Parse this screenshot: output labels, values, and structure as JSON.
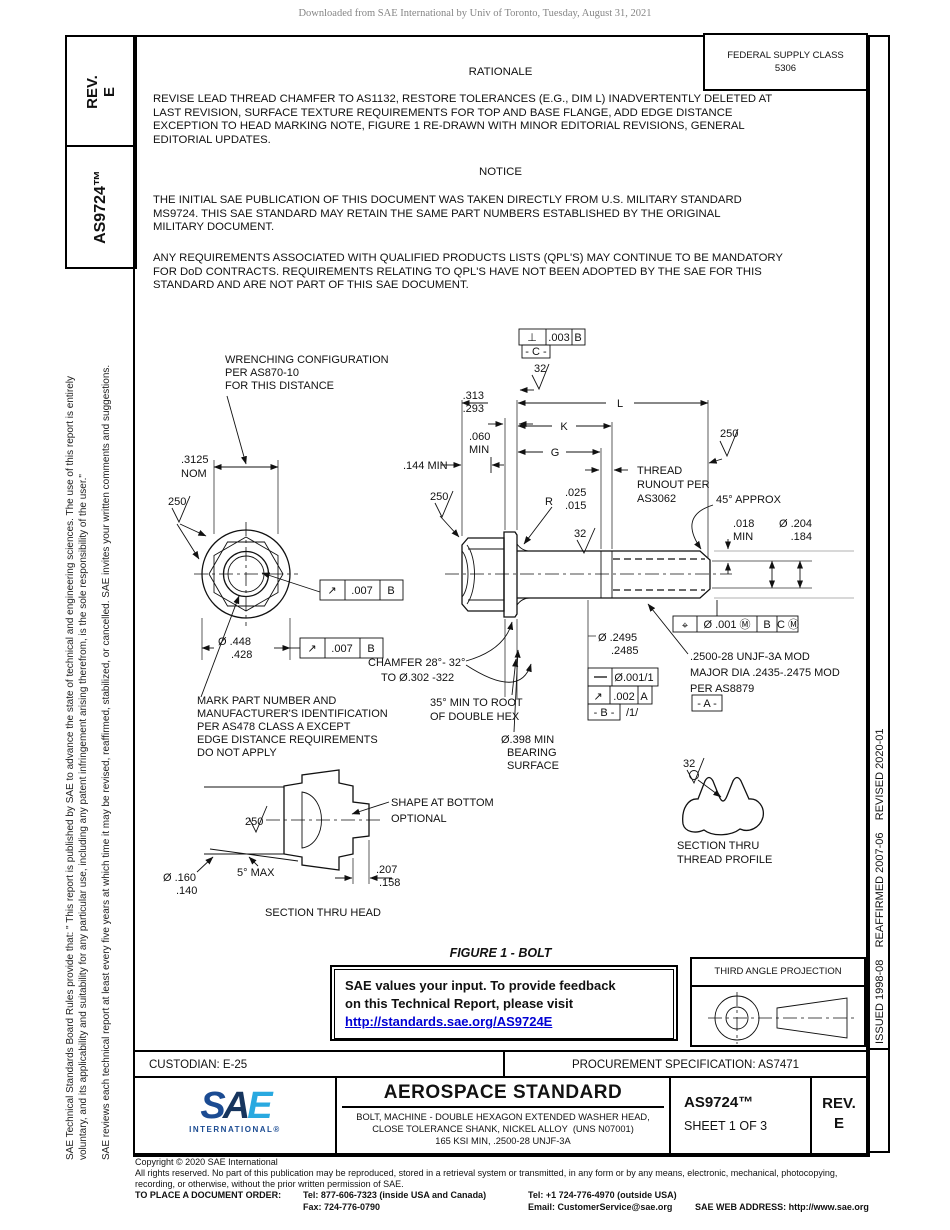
{
  "watermark": "Downloaded from SAE International by Univ of Toronto, Tuesday, August 31, 2021",
  "left_tabs": {
    "rev": "REV.\nE",
    "doc_number": "AS9724™"
  },
  "sidebar": {
    "para1_lines": [
      "SAE Technical Standards Board Rules provide that: \" This report is published by SAE to advance the state of technical and engineering sciences. The use of this report is entirely",
      "voluntary, and its applicability and suitability for any particular use, including any patent infringement arising therefrom, is the sole responsibility of the user.\""
    ],
    "para2": "SAE reviews each technical report at least every five years at which time it may be revised, reaffirmed, stabilized, or cancelled. SAE invites your written comments and suggestions."
  },
  "right_strip": {
    "text": "ISSUED 1998-08    REAFFIRMED 2007-06    REVISED 2020-01"
  },
  "fsc": {
    "line1": "FEDERAL SUPPLY CLASS",
    "line2": "5306"
  },
  "rationale": {
    "title": "RATIONALE",
    "body_lines": [
      "REVISE LEAD THREAD CHAMFER TO AS1132, RESTORE TOLERANCES (E.G., DIM L) INADVERTENTLY DELETED AT",
      "LAST REVISION, SURFACE TEXTURE REQUIREMENTS FOR TOP AND BASE FLANGE, ADD EDGE DISTANCE",
      "EXCEPTION TO HEAD MARKING NOTE, FIGURE 1 RE-DRAWN WITH MINOR EDITORIAL REVISIONS, GENERAL",
      "EDITORIAL UPDATES."
    ]
  },
  "notice": {
    "title": "NOTICE",
    "para1_lines": [
      "THE INITIAL SAE PUBLICATION OF THIS DOCUMENT WAS TAKEN DIRECTLY FROM U.S. MILITARY STANDARD",
      "MS9724. THIS SAE STANDARD MAY RETAIN THE SAME PART NUMBERS ESTABLISHED BY THE ORIGINAL",
      "MILITARY DOCUMENT."
    ],
    "para2_lines": [
      "ANY REQUIREMENTS ASSOCIATED WITH QUALIFIED PRODUCTS LISTS (QPL'S) MAY CONTINUE TO BE MANDATORY",
      "FOR DoD CONTRACTS. REQUIREMENTS RELATING TO QPL'S HAVE NOT BEEN ADOPTED BY THE SAE FOR THIS",
      "STANDARD AND ARE NOT PART OF THIS SAE DOCUMENT."
    ]
  },
  "figure": {
    "caption": "FIGURE 1 - BOLT",
    "labels": [
      {
        "n": "wrenching-note",
        "x": 225,
        "y": 363,
        "lines": [
          "WRENCHING CONFIGURATION",
          "PER AS870-10",
          "FOR THIS DISTANCE"
        ]
      },
      {
        "n": "fcf-perp-sym",
        "x": 532,
        "y": 341,
        "anchor": "middle",
        "lines": [
          "⊥"
        ]
      },
      {
        "n": "fcf-perp-val",
        "x": 559,
        "y": 341,
        "anchor": "middle",
        "lines": [
          ".003"
        ]
      },
      {
        "n": "fcf-perp-datum",
        "x": 578,
        "y": 341,
        "anchor": "middle",
        "lines": [
          "B"
        ]
      },
      {
        "n": "datum-c",
        "x": 536,
        "y": 355,
        "anchor": "middle",
        "lines": [
          "- C -"
        ]
      },
      {
        "n": "finish-32-top",
        "x": 534,
        "y": 372,
        "lines": [
          "32"
        ]
      },
      {
        "n": "dim-313-293",
        "x": 484,
        "y": 399,
        "anchor": "end",
        "lines": [
          ".313",
          ".293"
        ]
      },
      {
        "n": "dim-L",
        "x": 620,
        "y": 407,
        "anchor": "middle",
        "lines": [
          "L"
        ]
      },
      {
        "n": "dim-K",
        "x": 564,
        "y": 430,
        "anchor": "middle",
        "lines": [
          "K"
        ]
      },
      {
        "n": "dim-G",
        "x": 555,
        "y": 456,
        "anchor": "middle",
        "lines": [
          "G"
        ]
      },
      {
        "n": "dim-060-min",
        "x": 469,
        "y": 440,
        "lines": [
          ".060",
          "MIN"
        ]
      },
      {
        "n": "dim-144-min",
        "x": 403,
        "y": 469,
        "lines": [
          ".144 MIN"
        ]
      },
      {
        "n": "finish-250-shank-end",
        "x": 720,
        "y": 437,
        "lines": [
          "250"
        ]
      },
      {
        "n": "thread-runout-note",
        "x": 637,
        "y": 474,
        "lh": 14,
        "lines": [
          "THREAD",
          "RUNOUT PER",
          "AS3062"
        ]
      },
      {
        "n": "angle-45-approx",
        "x": 716,
        "y": 503,
        "lines": [
          "45° APPROX"
        ]
      },
      {
        "n": "finish-250-head-side",
        "x": 430,
        "y": 500,
        "lines": [
          "250"
        ]
      },
      {
        "n": "radius-r",
        "x": 553,
        "y": 505,
        "anchor": "end",
        "lines": [
          "R"
        ]
      },
      {
        "n": "dim-r-values",
        "x": 565,
        "y": 496,
        "lines": [
          ".025",
          ".015"
        ]
      },
      {
        "n": "dim-018-min",
        "x": 733,
        "y": 527,
        "lines": [
          ".018",
          "MIN"
        ]
      },
      {
        "n": "dim-204-184",
        "x": 812,
        "y": 527,
        "anchor": "end",
        "lines": [
          "Ø .204",
          ".184"
        ]
      },
      {
        "n": "finish-32-shank",
        "x": 574,
        "y": 537,
        "lines": [
          "32"
        ]
      },
      {
        "n": "dim-3125-nom",
        "x": 181,
        "y": 463,
        "lh": 14,
        "lines": [
          ".3125",
          "NOM"
        ]
      },
      {
        "n": "finish-250-head-top",
        "x": 168,
        "y": 505,
        "lines": [
          "250"
        ]
      },
      {
        "n": "dim-2495-2485",
        "x": 598,
        "y": 641,
        "indent": 13,
        "lines": [
          "Ø .2495",
          ".2485"
        ]
      },
      {
        "n": "pos-sym",
        "x": 685,
        "y": 629,
        "anchor": "middle",
        "lines": [
          "⌖"
        ]
      },
      {
        "n": "pos-val",
        "x": 727,
        "y": 628,
        "anchor": "middle",
        "lines": [
          "Ø .001 Ⓜ"
        ]
      },
      {
        "n": "pos-datum-b",
        "x": 767,
        "y": 628,
        "anchor": "middle",
        "lines": [
          "B"
        ]
      },
      {
        "n": "pos-datum-c",
        "x": 788,
        "y": 628,
        "anchor": "middle",
        "lines": [
          "C Ⓜ"
        ]
      },
      {
        "n": "thread-spec-note",
        "x": 690,
        "y": 660,
        "lh": 16,
        "lines": [
          ".2500-28 UNJF-3A MOD",
          "MAJOR DIA .2435-.2475 MOD",
          "PER AS8879"
        ]
      },
      {
        "n": "datum-a",
        "x": 707,
        "y": 707,
        "anchor": "middle",
        "lines": [
          "- A -"
        ]
      },
      {
        "n": "straight-val",
        "x": 634,
        "y": 681,
        "anchor": "middle",
        "lines": [
          "Ø.001/1"
        ]
      },
      {
        "n": "runout-shank-sym",
        "x": 598,
        "y": 700,
        "anchor": "middle",
        "lines": [
          "↗"
        ]
      },
      {
        "n": "runout-shank-val",
        "x": 624,
        "y": 700,
        "anchor": "middle",
        "lines": [
          ".002"
        ]
      },
      {
        "n": "runout-shank-datum",
        "x": 644,
        "y": 700,
        "anchor": "middle",
        "lines": [
          "A"
        ]
      },
      {
        "n": "datum-b",
        "x": 604,
        "y": 716,
        "anchor": "middle",
        "lines": [
          "- B -"
        ]
      },
      {
        "n": "flag-1",
        "x": 626,
        "y": 716,
        "lines": [
          "/1/"
        ]
      },
      {
        "n": "dim-448-428",
        "x": 218,
        "y": 645,
        "indent": 13,
        "lines": [
          "Ø .448",
          ".428"
        ]
      },
      {
        "n": "runout-lower-sym",
        "x": 312,
        "y": 652,
        "anchor": "middle",
        "lines": [
          "↗"
        ]
      },
      {
        "n": "runout-lower-val",
        "x": 342,
        "y": 652,
        "anchor": "middle",
        "lines": [
          ".007"
        ]
      },
      {
        "n": "runout-lower-datum",
        "x": 371,
        "y": 652,
        "anchor": "middle",
        "lines": [
          "B"
        ]
      },
      {
        "n": "runout-upper-sym",
        "x": 332,
        "y": 594,
        "anchor": "middle",
        "lines": [
          "↗"
        ]
      },
      {
        "n": "runout-upper-val",
        "x": 362,
        "y": 594,
        "anchor": "middle",
        "lines": [
          ".007"
        ]
      },
      {
        "n": "runout-upper-datum",
        "x": 391,
        "y": 594,
        "anchor": "middle",
        "lines": [
          "B"
        ]
      },
      {
        "n": "chamfer-note",
        "x": 368,
        "y": 666,
        "indent": 13,
        "lh": 15,
        "lines": [
          "CHAMFER 28°- 32°",
          "TO Ø.302 -322"
        ]
      },
      {
        "n": "note-35-min",
        "x": 430,
        "y": 706,
        "lh": 14,
        "lines": [
          "35° MIN TO ROOT",
          "OF DOUBLE HEX"
        ]
      },
      {
        "n": "note-bearing",
        "x": 501,
        "y": 743,
        "indent": 6,
        "lines": [
          "Ø.398 MIN",
          "BEARING",
          "SURFACE"
        ]
      },
      {
        "n": "mark-note",
        "x": 197,
        "y": 704,
        "lines": [
          "MARK PART NUMBER AND",
          "MANUFACTURER'S IDENTIFICATION",
          "PER AS478 CLASS A EXCEPT",
          "EDGE DISTANCE REQUIREMENTS",
          "DO NOT APPLY"
        ]
      },
      {
        "n": "shape-note",
        "x": 391,
        "y": 806,
        "lh": 16,
        "lines": [
          "SHAPE AT BOTTOM",
          "OPTIONAL"
        ]
      },
      {
        "n": "finish-250-section",
        "x": 245,
        "y": 825,
        "lines": [
          "250"
        ]
      },
      {
        "n": "angle-5-max",
        "x": 237,
        "y": 876,
        "lines": [
          "5° MAX"
        ]
      },
      {
        "n": "dim-160-140",
        "x": 163,
        "y": 881,
        "indent": 13,
        "lines": [
          "Ø .160",
          ".140"
        ]
      },
      {
        "n": "dim-207-158",
        "x": 376,
        "y": 873,
        "indent": 3,
        "lines": [
          ".207",
          ".158"
        ]
      },
      {
        "n": "caption-section-head",
        "x": 323,
        "y": 916,
        "anchor": "middle",
        "lines": [
          "SECTION THRU HEAD"
        ]
      },
      {
        "n": "finish-32-profile",
        "x": 683,
        "y": 767,
        "lines": [
          "32"
        ]
      },
      {
        "n": "caption-section-thread",
        "x": 677,
        "y": 849,
        "lh": 14,
        "lines": [
          "SECTION THRU",
          "THREAD PROFILE"
        ]
      }
    ]
  },
  "feedback": {
    "line1": "SAE values your input. To provide feedback",
    "line2": "on this Technical Report, please visit",
    "link": "http://standards.sae.org/AS9724E"
  },
  "projection": {
    "title": "THIRD ANGLE PROJECTION"
  },
  "footer": {
    "custodian": "CUSTODIAN: E-25",
    "procurement": "PROCUREMENT SPECIFICATION: AS7471",
    "standard_title": "AEROSPACE STANDARD",
    "desc_lines": [
      "BOLT, MACHINE - DOUBLE HEXAGON EXTENDED WASHER HEAD,",
      "CLOSE TOLERANCE SHANK, NICKEL ALLOY  (UNS N07001)",
      "165 KSI MIN, .2500-28 UNJF-3A"
    ],
    "doc_number": "AS9724™",
    "sheet": "SHEET 1 OF 3",
    "rev_label": "REV.",
    "rev_value": "E",
    "logo": {
      "s": "S",
      "a": "A",
      "e": "E",
      "sub": "INTERNATIONAL®"
    }
  },
  "copyright": {
    "lines": [
      "Copyright © 2020 SAE International",
      "All rights reserved. No part of this publication may be reproduced, stored in a retrieval system or transmitted, in any form or by any means, electronic, mechanical, photocopying,",
      "recording, or otherwise, without the prior written permission of SAE."
    ],
    "order_label": "TO PLACE A DOCUMENT ORDER:",
    "tel_inside": "Tel: 877-606-7323 (inside USA and Canada)",
    "tel_outside": "Tel: +1 724-776-4970 (outside USA)",
    "fax": "Fax: 724-776-0790",
    "email": "Email: CustomerService@sae.org",
    "web": "SAE WEB ADDRESS: http://www.sae.org"
  },
  "colors": {
    "link_blue": "#0000d4",
    "logo_dark": "#1b4b92",
    "logo_navy": "#16355e",
    "logo_cyan": "#29a9e0"
  }
}
